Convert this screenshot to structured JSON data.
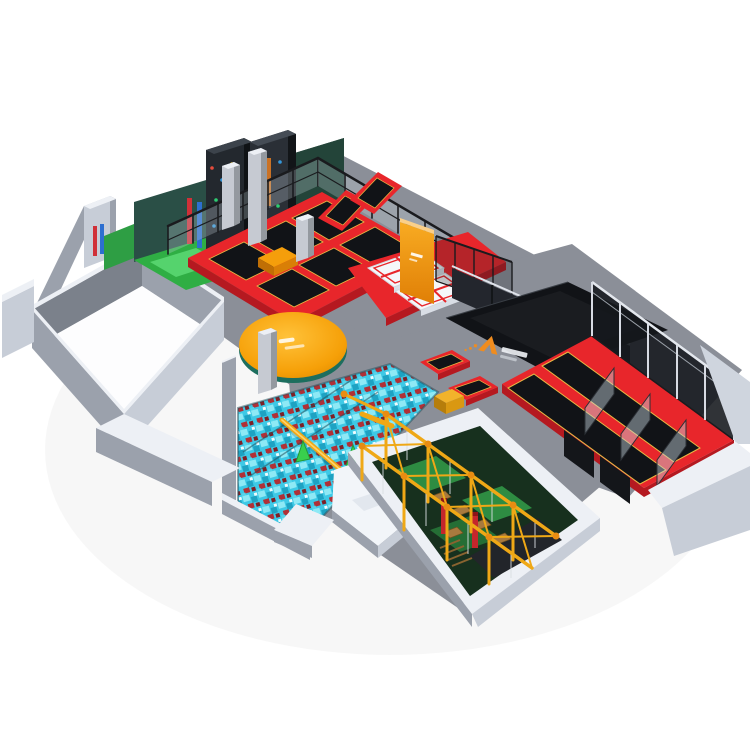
{
  "image": {
    "width": 750,
    "height": 750,
    "alt": "3D isometric render of an indoor trampoline park: trampoline court with banked walls, climbing zone, orange round stage, airbag jump zone, branded black mat, foam cube pit with joust beam, adventure ropes course and long performance trampoline lanes inside gray walls"
  },
  "icons": {
    "brand_logo": "orange-triangle-A-logo",
    "brand_wordmark": "white-cjk-wordmark",
    "stage_mark": "white-wordmark",
    "wall_mark": "white-wordmark"
  },
  "colors": {
    "background": "#ffffff",
    "floor": "#8b8f98",
    "room_floor": "#fdfdfe",
    "wall_top": "#edf0f5",
    "wall_light": "#c7cdd7",
    "wall_mid": "#9ba1ac",
    "wall_dark": "#7b818b",
    "red": "#e8262b",
    "red_dark": "#b51920",
    "mat_black": "#111317",
    "trim_yellow": "#e9b944",
    "orange": "#f59e0b",
    "orange_deep": "#d97f06",
    "teal_wall": "#2a4f46",
    "climb_green": "#2fae44",
    "pit_green": "#2e8c42",
    "pit_green_dark": "#17301e",
    "foam_cyan": "#3ec9e6",
    "foam_red": "#b03036",
    "truss_yellow": "#efa816",
    "railing_black": "#1a1b1e",
    "column_gray": "#c6cad2",
    "column_shade": "#94999f",
    "white_mat": "#f5f7fa",
    "brand_orange": "#f08c1e",
    "glass": "#c8d7e0"
  }
}
